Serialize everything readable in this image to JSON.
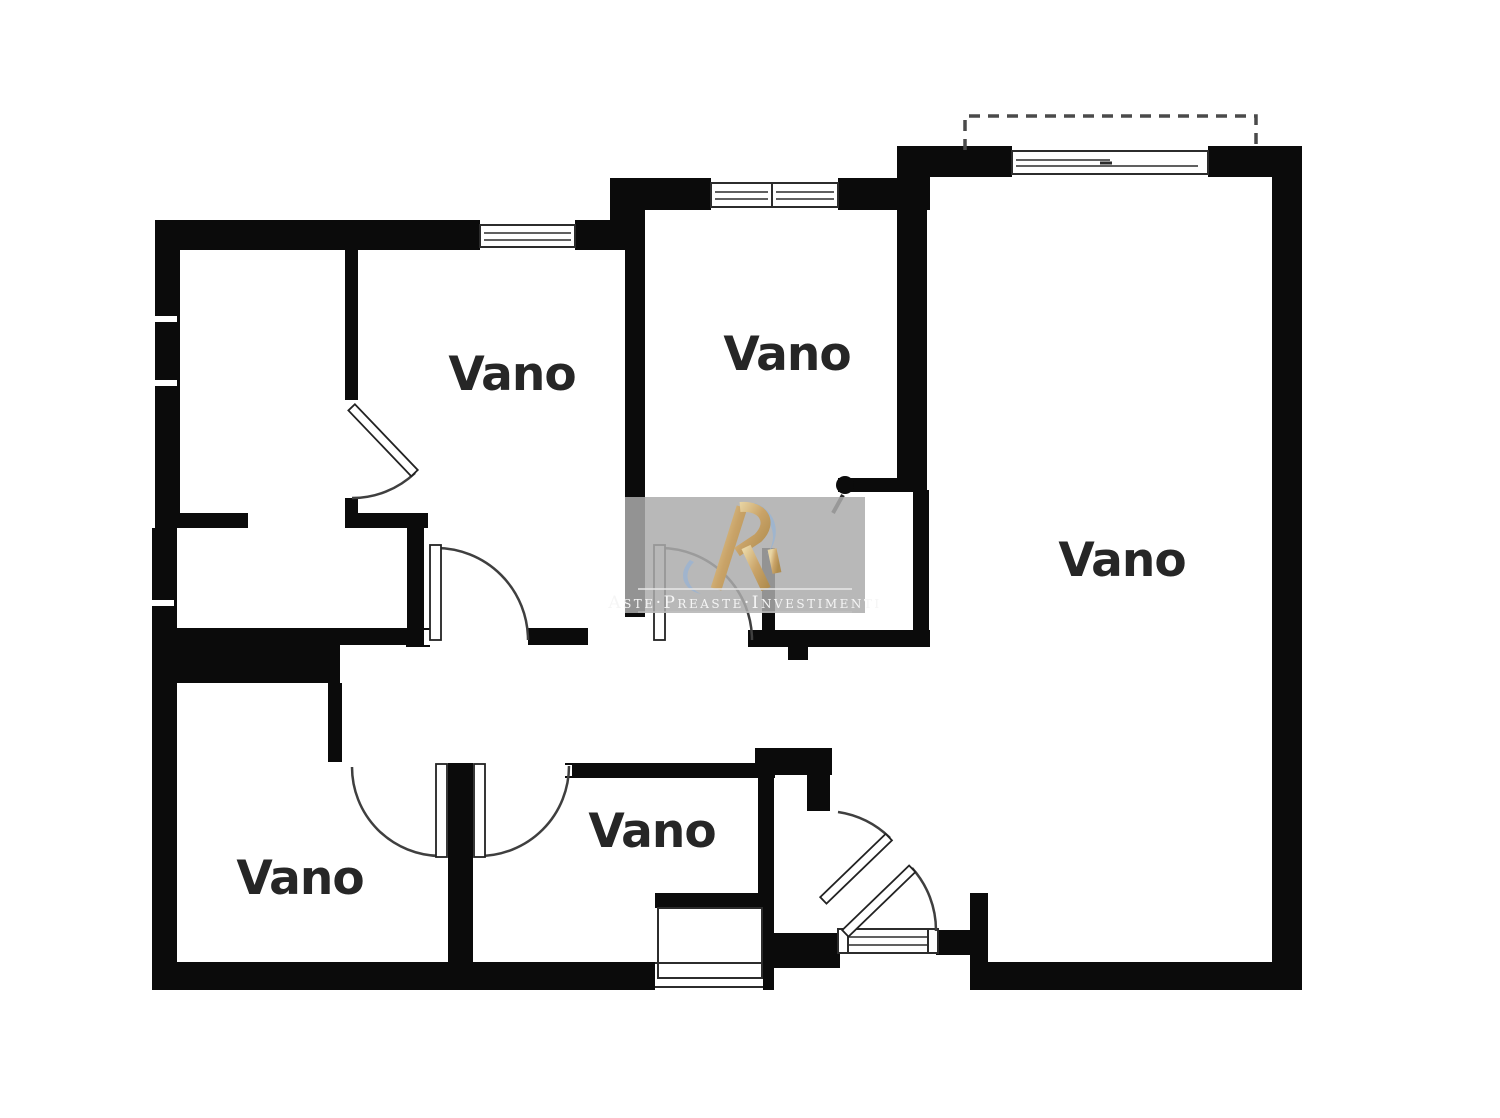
{
  "plan": {
    "title": "floor-plan",
    "room_labels": [
      {
        "id": "room-top-left",
        "text": "Vano"
      },
      {
        "id": "room-top-middle",
        "text": "Vano"
      },
      {
        "id": "room-right-large",
        "text": "Vano"
      },
      {
        "id": "room-bottom-middle",
        "text": "Vano"
      },
      {
        "id": "room-bottom-left",
        "text": "Vano"
      }
    ]
  },
  "watermark": {
    "text": "Aste·Preaste·Investimenti",
    "logo": "ri-monogram"
  },
  "colors": {
    "background": "#ffffff",
    "wall": "#0b0b0b",
    "door_line": "#3f3f3f",
    "label": "#262626",
    "watermark_bg": "#ababab",
    "watermark_text": "#f5f5f5",
    "logo_gold": "#c9a368",
    "logo_gold_light": "#ecd9a8",
    "logo_blue": "#9db4cf"
  }
}
